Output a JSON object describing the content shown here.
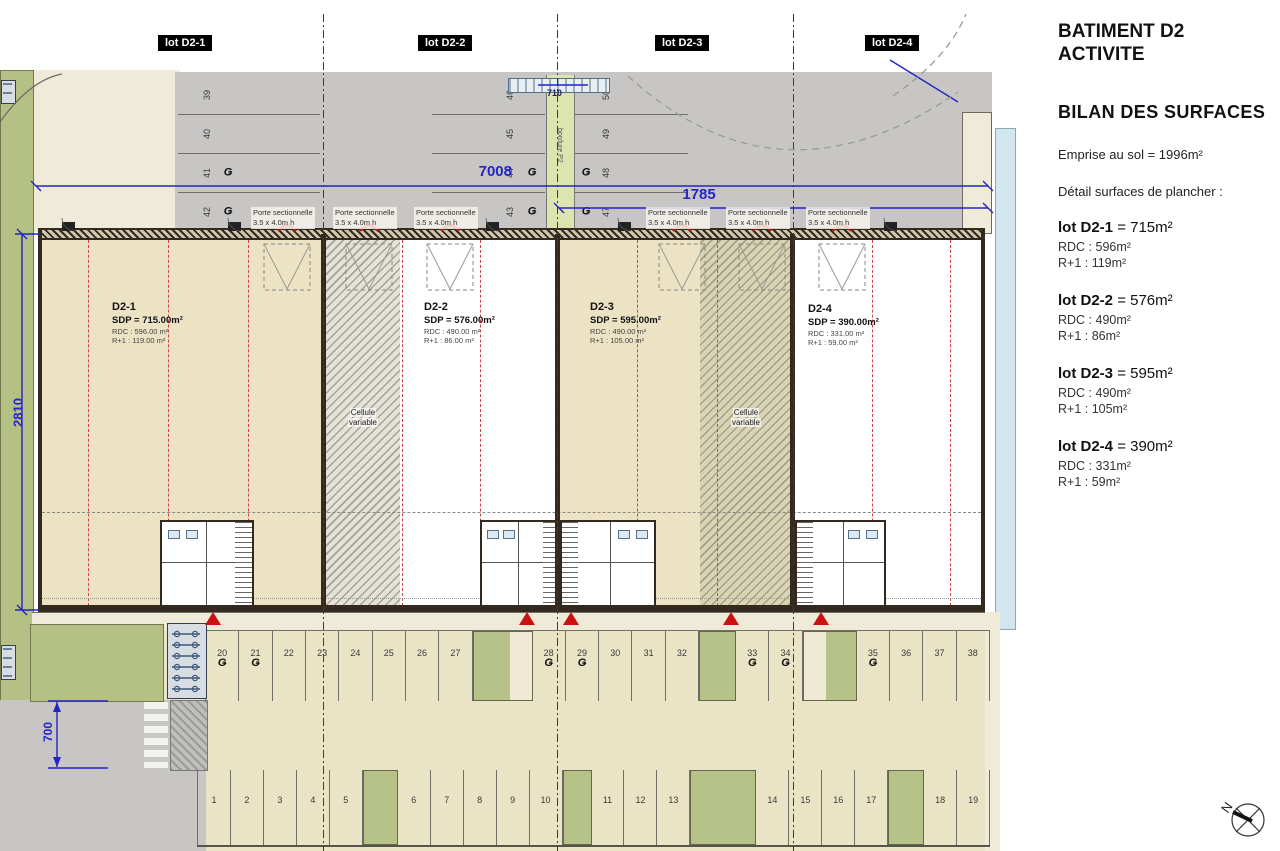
{
  "panel": {
    "title_lines": [
      "BATIMENT D2",
      "ACTIVITE"
    ],
    "section_title": "BILAN DES SURFACES",
    "emprise_line": "Emprise au sol = 1996m²",
    "detail_line": "Détail surfaces de plancher :",
    "lots": [
      {
        "name": "lot D2-1",
        "total": "= 715m²",
        "rdc": "RDC : 596m²",
        "r1": "R+1 : 119m²"
      },
      {
        "name": "lot D2-2",
        "total": "= 576m²",
        "rdc": "RDC : 490m²",
        "r1": "R+1 : 86m²"
      },
      {
        "name": "lot D2-3",
        "total": "= 595m²",
        "rdc": "RDC : 490m²",
        "r1": "R+1 : 105m²"
      },
      {
        "name": "lot D2-4",
        "total": "= 390m²",
        "rdc": "RDC : 331m²",
        "r1": "R+1 : 59m²"
      }
    ]
  },
  "plan": {
    "lot_tags": [
      {
        "label": "lot D2-1"
      },
      {
        "label": "lot D2-2"
      },
      {
        "label": "lot D2-3"
      },
      {
        "label": "lot D2-4"
      }
    ],
    "units": [
      {
        "id": "D2-1",
        "sdp": "SDP = 715.00m²",
        "rdc": "RDC : 596.00 m²",
        "r1": "R+1 : 119.00 m²"
      },
      {
        "id": "D2-2",
        "sdp": "SDP = 576.00m²",
        "rdc": "RDC : 490.00 m²",
        "r1": "R+1 : 86.00 m²"
      },
      {
        "id": "D2-3",
        "sdp": "SDP = 595.00m²",
        "rdc": "RDC : 490.00 m²",
        "r1": "R+1 : 105.00 m²"
      },
      {
        "id": "D2-4",
        "sdp": "SDP = 390.00m²",
        "rdc": "RDC : 331.00 m²",
        "r1": "R+1 : 59.00 m²"
      }
    ],
    "door_label": {
      "line1": "Porte sectionnelle",
      "line2": "3.5 x 4.0m h"
    },
    "cellule": {
      "line1": "Cellule",
      "line2": "variable"
    },
    "dims": {
      "d7008": "7008",
      "d1785": "1785",
      "d2810": "2810",
      "d700": "700",
      "d710": "710"
    },
    "ev_symbol": "Ǥ",
    "north_label": "N",
    "bordure_label": "bordure P2",
    "colors": {
      "dimension_blue": "#2424c8",
      "marker_red": "#cc1111",
      "grass_green": "#b4c084"
    },
    "parking": {
      "top_left": [
        {
          "n": "39"
        },
        {
          "n": "40"
        },
        {
          "n": "41",
          "ev": true
        },
        {
          "n": "42",
          "ev": true
        }
      ],
      "top_mid_left": [
        {
          "n": "46"
        },
        {
          "n": "45"
        },
        {
          "n": "44",
          "ev": true
        },
        {
          "n": "43",
          "ev": true
        }
      ],
      "top_mid_right": [
        {
          "n": "50"
        },
        {
          "n": "49"
        },
        {
          "n": "48",
          "ev": true
        },
        {
          "n": "47",
          "ev": true
        }
      ],
      "middle_row": [
        {
          "n": "20",
          "ev": true
        },
        {
          "n": "21",
          "ev": true
        },
        {
          "n": "22"
        },
        {
          "n": "23"
        },
        {
          "n": "24"
        },
        {
          "n": "25"
        },
        {
          "n": "26"
        },
        {
          "n": "27"
        },
        {
          "island": "green-cream",
          "w": 58
        },
        {
          "n": "28",
          "ev": true
        },
        {
          "n": "29",
          "ev": true
        },
        {
          "n": "30"
        },
        {
          "n": "31"
        },
        {
          "n": "32"
        },
        {
          "island": "green",
          "w": 35
        },
        {
          "n": "33",
          "ev": true
        },
        {
          "n": "34",
          "ev": true
        },
        {
          "island": "cream-green",
          "w": 52
        },
        {
          "n": "35",
          "ev": true
        },
        {
          "n": "36"
        },
        {
          "n": "37"
        },
        {
          "n": "38"
        }
      ],
      "bottom_row": [
        {
          "n": "1"
        },
        {
          "n": "2"
        },
        {
          "n": "3"
        },
        {
          "n": "4"
        },
        {
          "n": "5"
        },
        {
          "island": "green",
          "w": 33
        },
        {
          "n": "6"
        },
        {
          "n": "7"
        },
        {
          "n": "8"
        },
        {
          "n": "9"
        },
        {
          "n": "10"
        },
        {
          "island": "green",
          "w": 27
        },
        {
          "n": "11"
        },
        {
          "n": "12"
        },
        {
          "n": "13"
        },
        {
          "island": "green",
          "w": 64
        },
        {
          "n": "14"
        },
        {
          "n": "15"
        },
        {
          "n": "16"
        },
        {
          "n": "17"
        },
        {
          "island": "green",
          "w": 34
        },
        {
          "n": "18"
        },
        {
          "n": "19"
        }
      ]
    }
  }
}
